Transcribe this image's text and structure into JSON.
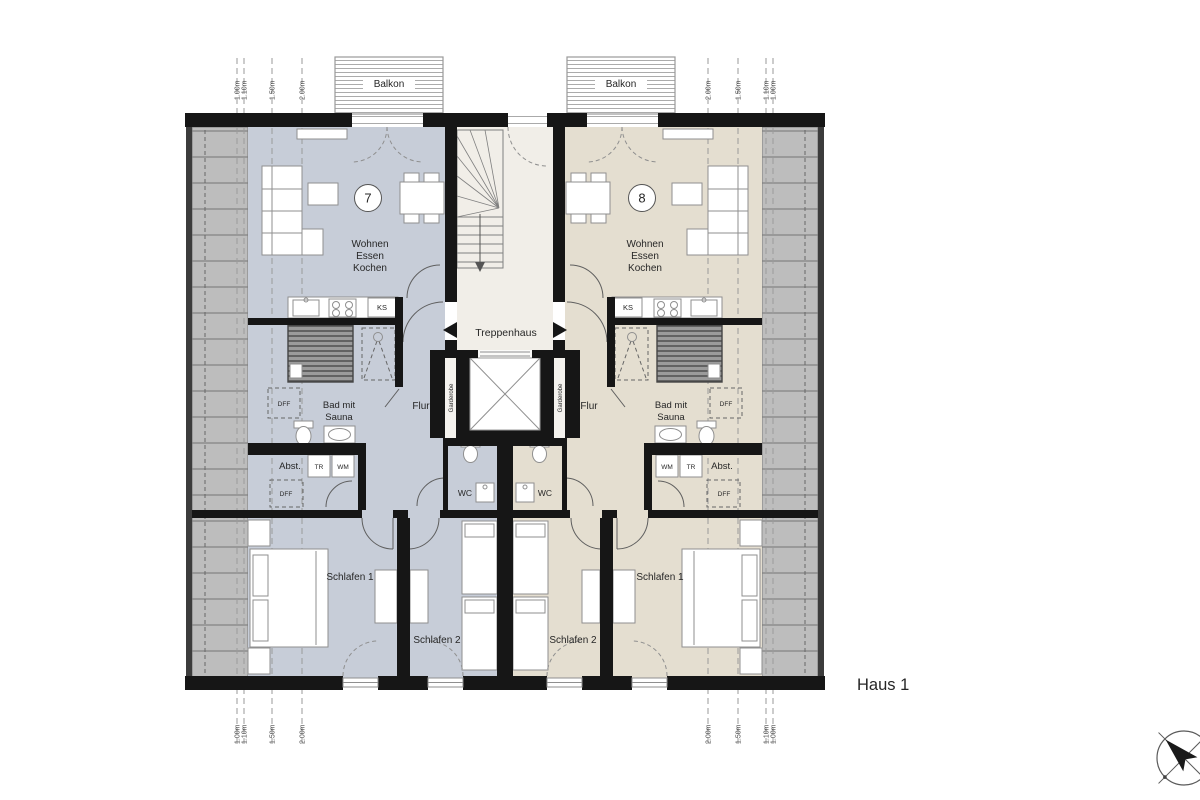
{
  "title": "Haus 1",
  "stairwell": {
    "label": "Treppenhaus",
    "wardrobe_left": "Garderobe",
    "wardrobe_right": "Garderobe"
  },
  "balconies": {
    "left": "Balkon",
    "right": "Balkon"
  },
  "apartments": {
    "left": {
      "number": "7",
      "living_lines": [
        "Wohnen",
        "Essen",
        "Kochen"
      ],
      "bath_lines": [
        "Bad mit",
        "Sauna"
      ],
      "hall": "Flur",
      "storage": "Abst.",
      "wc": "WC",
      "bedroom1": "Schlafen 1",
      "bedroom2": "Schlafen 2",
      "fridge": "KS",
      "dryer": "TR",
      "washer": "WM",
      "roof_window_top": "DFF",
      "roof_window_bottom": "DFF"
    },
    "right": {
      "number": "8",
      "living_lines": [
        "Wohnen",
        "Essen",
        "Kochen"
      ],
      "bath_lines": [
        "Bad mit",
        "Sauna"
      ],
      "hall": "Flur",
      "storage": "Abst.",
      "wc": "WC",
      "bedroom1": "Schlafen 1",
      "bedroom2": "Schlafen 2",
      "fridge": "KS",
      "dryer": "TR",
      "washer": "WM",
      "roof_window_top": "DFF",
      "roof_window_bottom": "DFF"
    }
  },
  "dimensions": {
    "top_left": [
      "1.00m",
      "1.10m",
      "1.50m",
      "2.00m"
    ],
    "top_right": [
      "2.00m",
      "1.50m",
      "1.10m",
      "1.00m"
    ],
    "bottom_left": [
      "1.00m",
      "1.10m",
      "1.50m",
      "2.00m"
    ],
    "bottom_right": [
      "2.00m",
      "1.50m",
      "1.10m",
      "1.00m"
    ]
  },
  "icons": {
    "entrance_left": "arrow-left",
    "entrance_right": "arrow-right",
    "north_indicator": "compass-rose"
  },
  "colors": {
    "apartment_left_fill": "#c7cdd8",
    "apartment_right_fill": "#e4ded0",
    "stairwell_fill": "#f1eee8",
    "roof_fill": "#bdbdbd",
    "wall": "#161616"
  }
}
